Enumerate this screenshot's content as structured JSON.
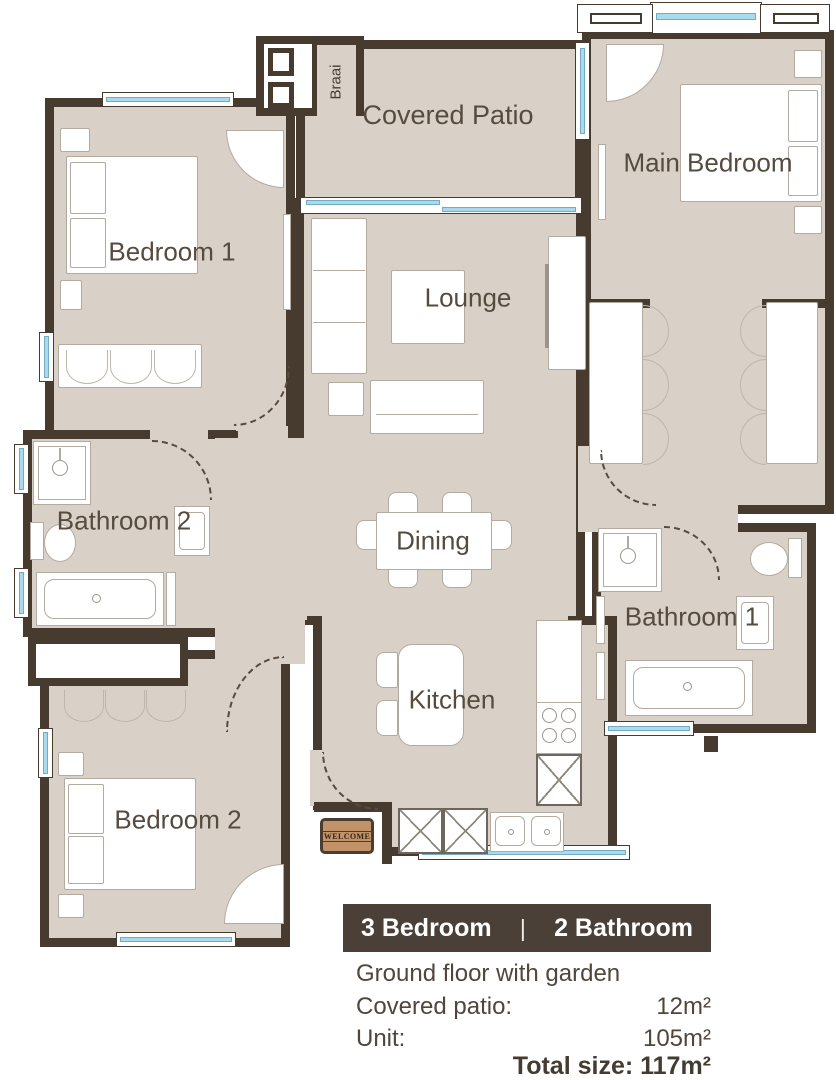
{
  "rooms": {
    "covered_patio": "Covered Patio",
    "braai": "Braai",
    "main_bedroom": "Main Bedroom",
    "bedroom_1": "Bedroom 1",
    "lounge": "Lounge",
    "bathroom_2": "Bathroom 2",
    "dining": "Dining",
    "bathroom_1": "Bathroom 1",
    "kitchen": "Kitchen",
    "bedroom_2": "Bedroom 2"
  },
  "entrance": {
    "mat_text": "WELCOME"
  },
  "summary": {
    "banner": {
      "left": "3 Bedroom",
      "divider": "|",
      "right": "2 Bathroom"
    },
    "subtitle": "Ground floor with garden",
    "areas": [
      {
        "label": "Covered patio:",
        "value": "12m²"
      },
      {
        "label": "Unit:",
        "value": "105m²"
      }
    ],
    "total": "Total size: 117m²"
  },
  "colors": {
    "wall": "#473b30",
    "floor": "#d9d1c7",
    "window_glass": "#a9dbee",
    "banner_bg": "#4a4038",
    "banner_text": "#ffffff",
    "label_text": "#564b3f",
    "mat_bg": "#c29268"
  }
}
